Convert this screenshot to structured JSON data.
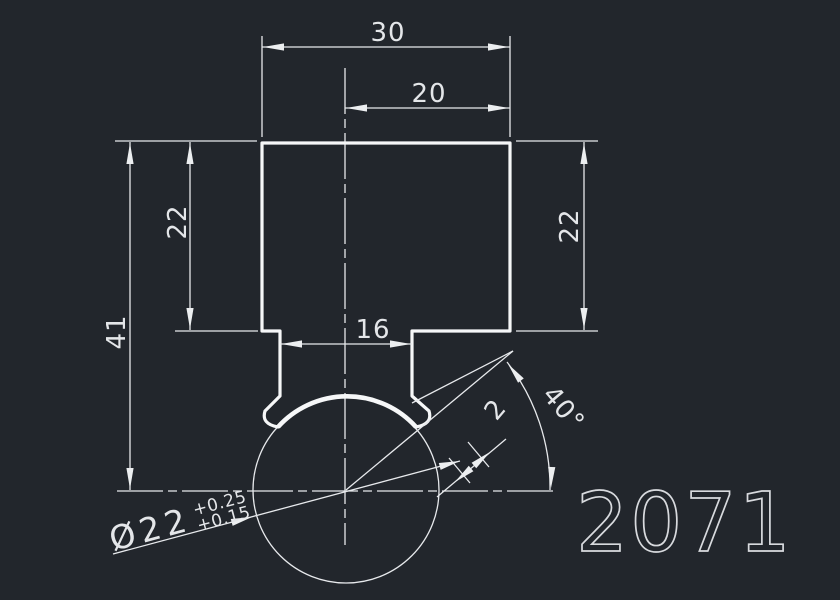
{
  "app": {
    "background": "#22262c",
    "line_color": "#e7e9ec",
    "outline_color": "#f6f7f8",
    "text_color": "#e4e6e9"
  },
  "drawing": {
    "dim_total_width": "30",
    "dim_right_width": "20",
    "dim_left_height": "22",
    "dim_right_height": "22",
    "dim_total_height": "41",
    "dim_neck_width": "16",
    "dim_angle": "40°",
    "dim_groove_width": "2",
    "dim_diameter": "Ø22",
    "dim_diameter_tol_upper": "+0.25",
    "dim_diameter_tol_lower": "+0.15",
    "part_number": "2071"
  }
}
